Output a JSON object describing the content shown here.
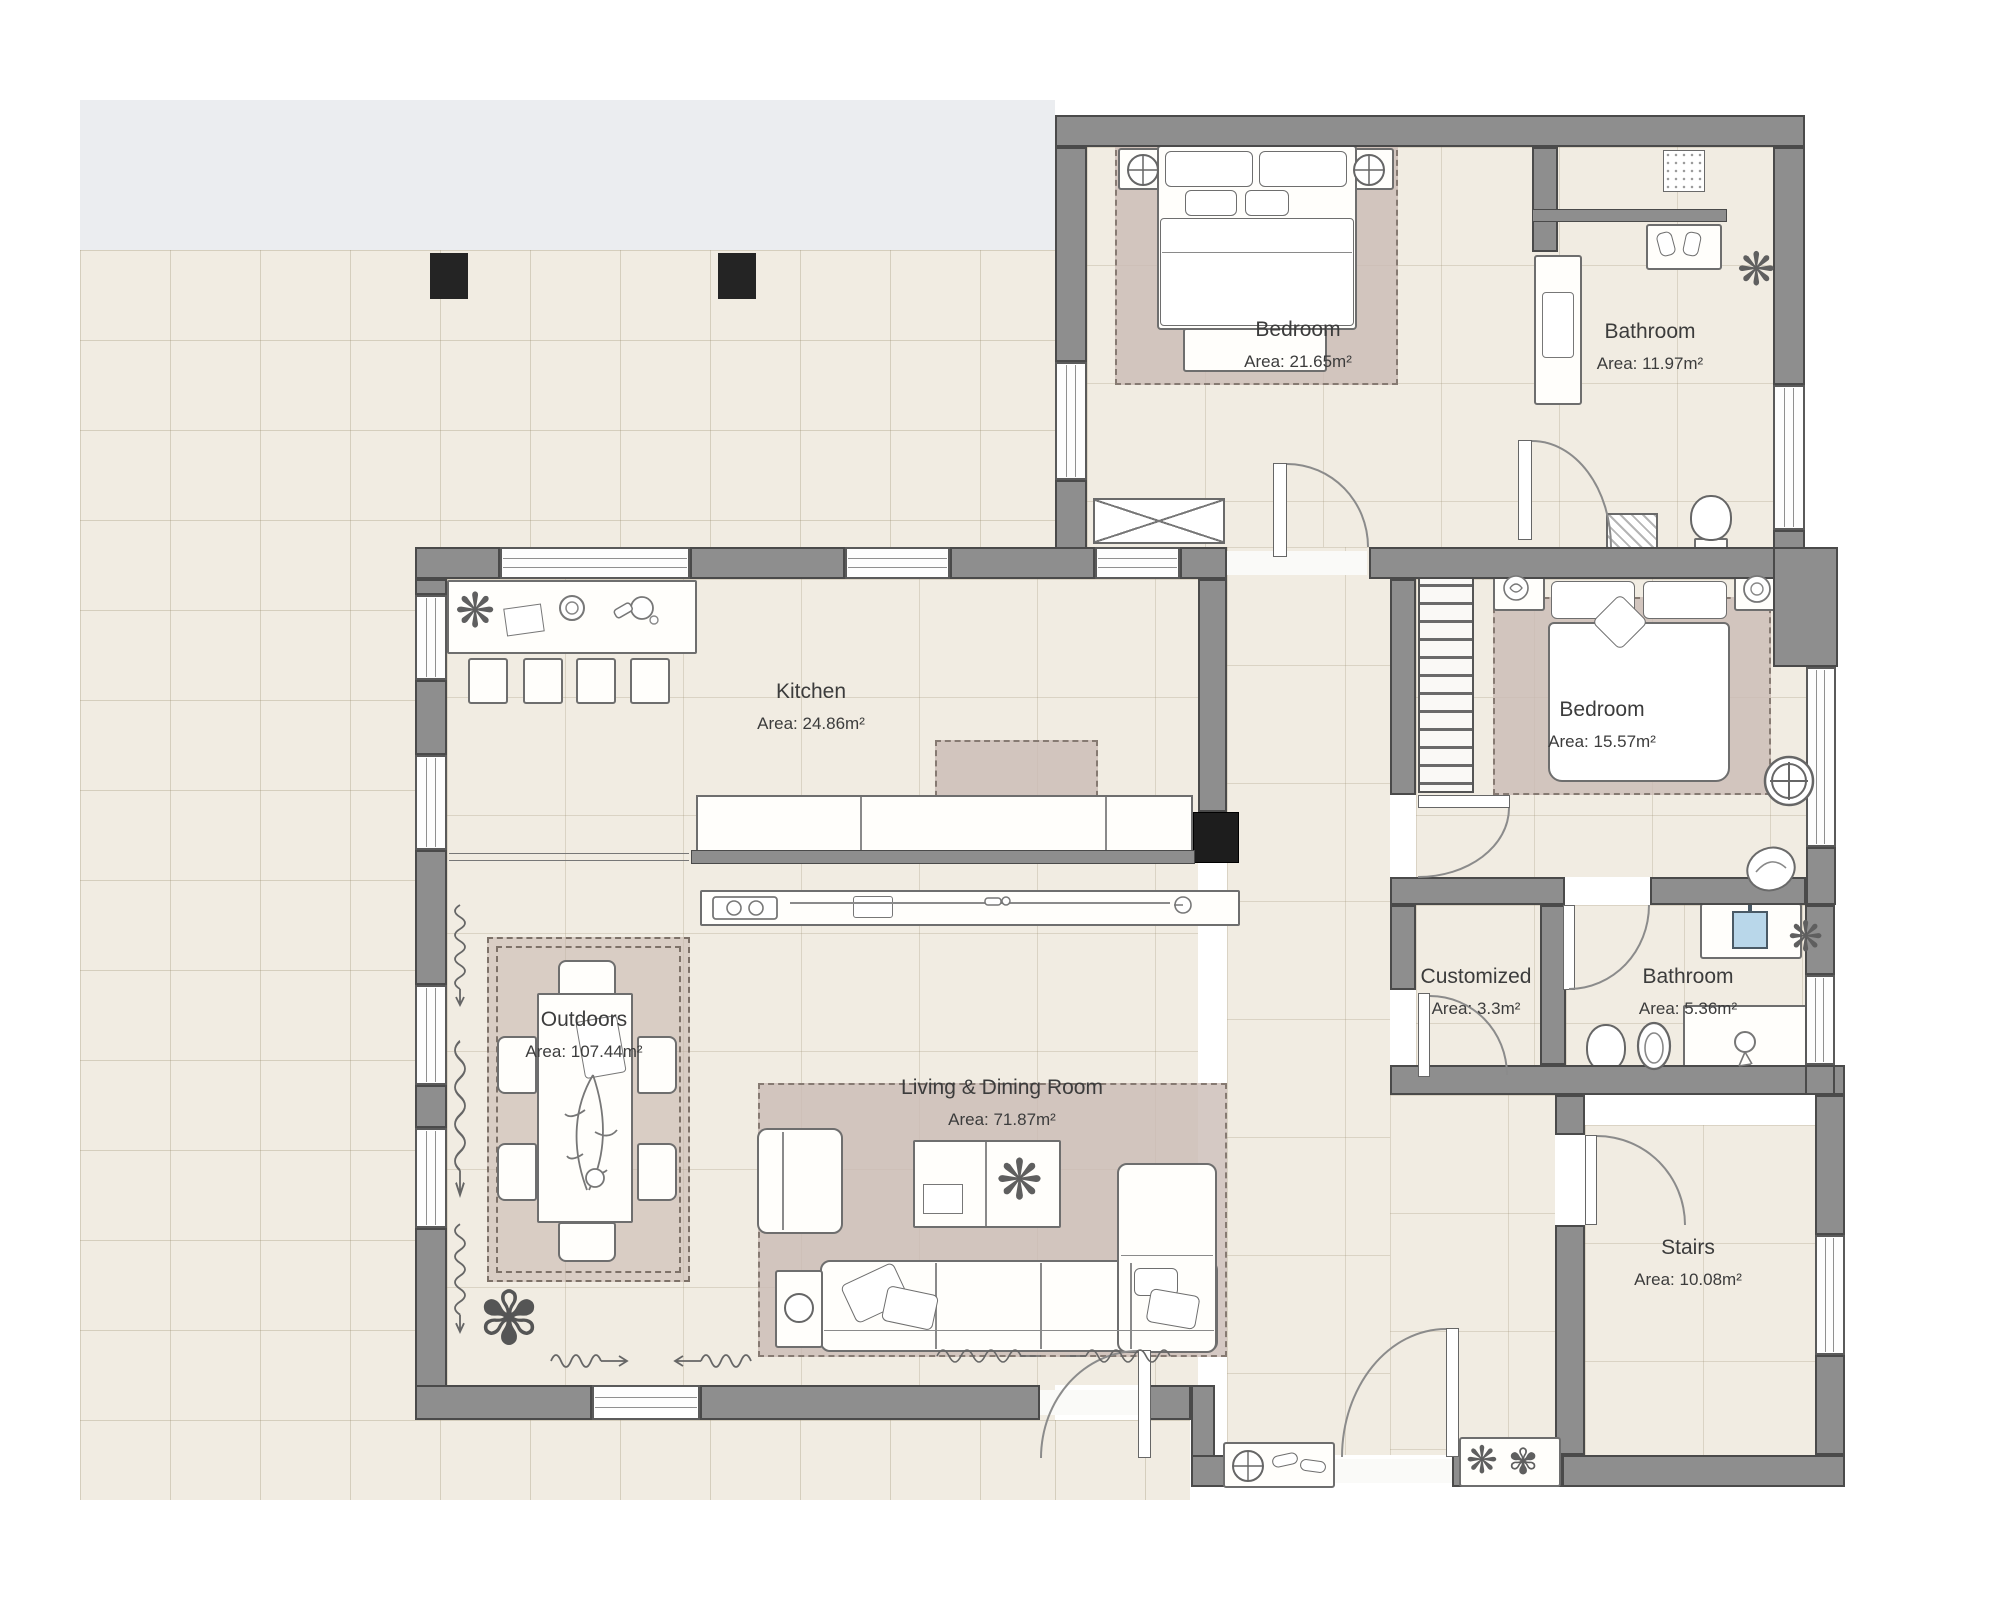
{
  "plan": {
    "type": "floor-plan",
    "rooms": [
      {
        "id": "bedroom-1",
        "name": "Bedroom",
        "area": "Area: 21.65m²"
      },
      {
        "id": "bathroom-1",
        "name": "Bathroom",
        "area": "Area: 11.97m²"
      },
      {
        "id": "kitchen",
        "name": "Kitchen",
        "area": "Area: 24.86m²"
      },
      {
        "id": "bedroom-2",
        "name": "Bedroom",
        "area": "Area: 15.57m²"
      },
      {
        "id": "customized",
        "name": "Customized",
        "area": "Area: 3.3m²"
      },
      {
        "id": "bathroom-2",
        "name": "Bathroom",
        "area": "Area: 5.36m²"
      },
      {
        "id": "outdoors",
        "name": "Outdoors",
        "area": "Area: 107.44m²"
      },
      {
        "id": "living-dining",
        "name": "Living & Dining Room",
        "area": "Area: 71.87m²"
      },
      {
        "id": "stairs",
        "name": "Stairs",
        "area": "Area: 10.08m²"
      }
    ],
    "colors": {
      "wall": "#8e8e8e",
      "wall_outline": "#4a4a4a",
      "floor_tile": "#f1ece2",
      "zone_highlight": "#cbbcb5",
      "terrace_band": "#ebedf0",
      "column_post": "#242424",
      "sink_blue": "#b9d7ea",
      "label_text": "#3c3c3c"
    },
    "glyphs": {
      "plant": "❋",
      "flower": "✾"
    }
  }
}
